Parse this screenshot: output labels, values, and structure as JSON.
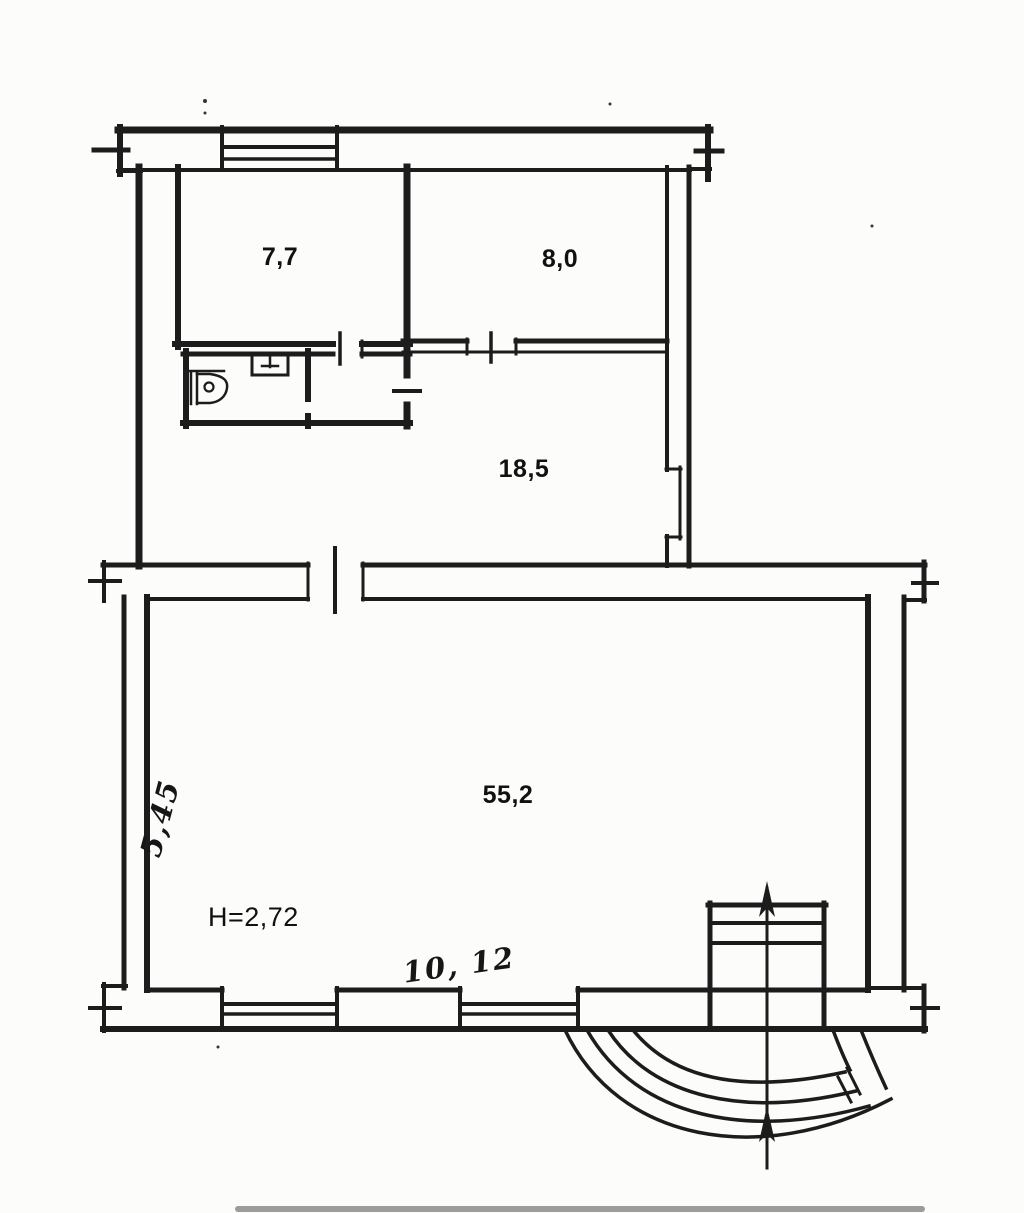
{
  "plan": {
    "room_labels": [
      {
        "id": "room-7-7",
        "text": "7,7"
      },
      {
        "id": "room-8-0",
        "text": "8,0"
      },
      {
        "id": "room-18-5",
        "text": "18,5"
      },
      {
        "id": "room-55-2",
        "text": "55,2"
      }
    ],
    "annotations": {
      "ceiling_height": "H=2,72",
      "dim_vertical": "5,45",
      "dim_horizontal": "10, 12"
    },
    "colors": {
      "ink": "#1c1c1c",
      "paper": "#fcfcfb"
    }
  }
}
